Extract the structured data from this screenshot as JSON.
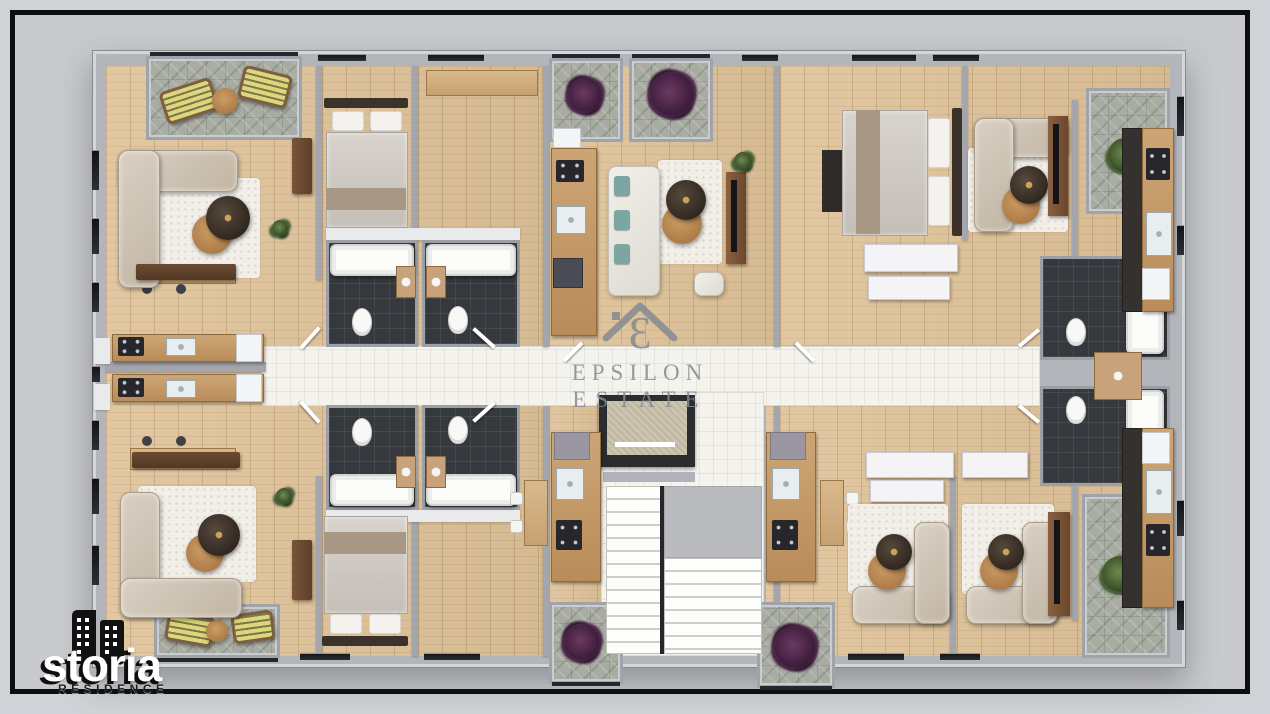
{
  "watermark": {
    "line1": "EPSILON",
    "line2": "ESTATE",
    "epsilon_glyph": "Ɛ",
    "icon": "epsilon-house-icon",
    "color": "#858a92"
  },
  "logo": {
    "name": "storia",
    "subtitle": "RESIDENCE",
    "icon": "buildings-icon",
    "name_color": "#ffffff",
    "subtitle_color": "#1f1f1f"
  },
  "palette": {
    "bg": "#cfd2d6",
    "frame": "#0e0e10",
    "wall": "#b2b5ba",
    "wood": "#d5ba92",
    "corridor": "#f4f3ed",
    "bath": "#35383c",
    "sofa": "#c2b5a3",
    "rug": "#f2efe9",
    "stone": "#a8aca2",
    "plant_purple": "#3a1b38",
    "plant_green": "#32471f",
    "lounger": "#dcd67c",
    "counter": "#b98c5a",
    "elevator": "#ccc4ae",
    "wm": "#858a92"
  }
}
